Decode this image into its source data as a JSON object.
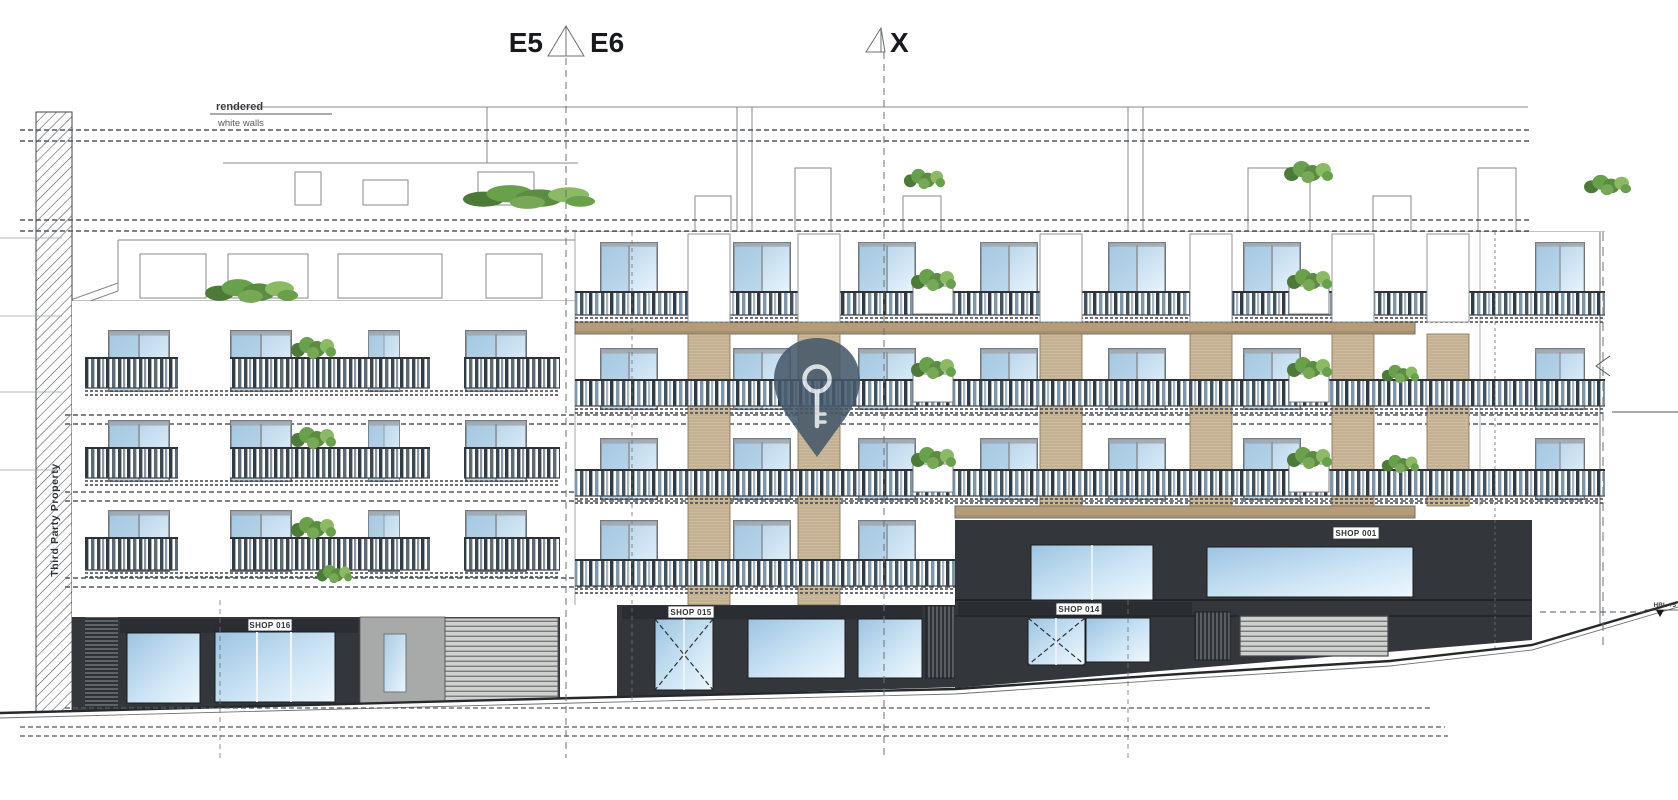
{
  "section_markers": {
    "e5": "E5",
    "e6": "E6",
    "x": "X"
  },
  "annotations": {
    "rendered": "rendered",
    "white_walls": "white walls",
    "third_party_property": "Third Party Property",
    "level_right": "HBL +5"
  },
  "shops": {
    "shop016": "SHOP 016",
    "shop015": "SHOP 015",
    "shop014": "SHOP 014",
    "shop001": "SHOP 001"
  },
  "colors": {
    "shop_dark": "#33373b",
    "shop_bar": "#2a2e32",
    "grey_wall": "#a8aaa9",
    "tan_slab": "#b49c78",
    "tan_pilaster": "#cdbb9d",
    "glass_light": "#e9f5fd",
    "glass_mid": "#aecde6",
    "green": "#69a04b",
    "pin": "#44586a",
    "rail_dark": "#2f3b46",
    "rail_blue": "#7d96aa",
    "line_dark": "#26292c",
    "line_mid": "#6c7074"
  }
}
